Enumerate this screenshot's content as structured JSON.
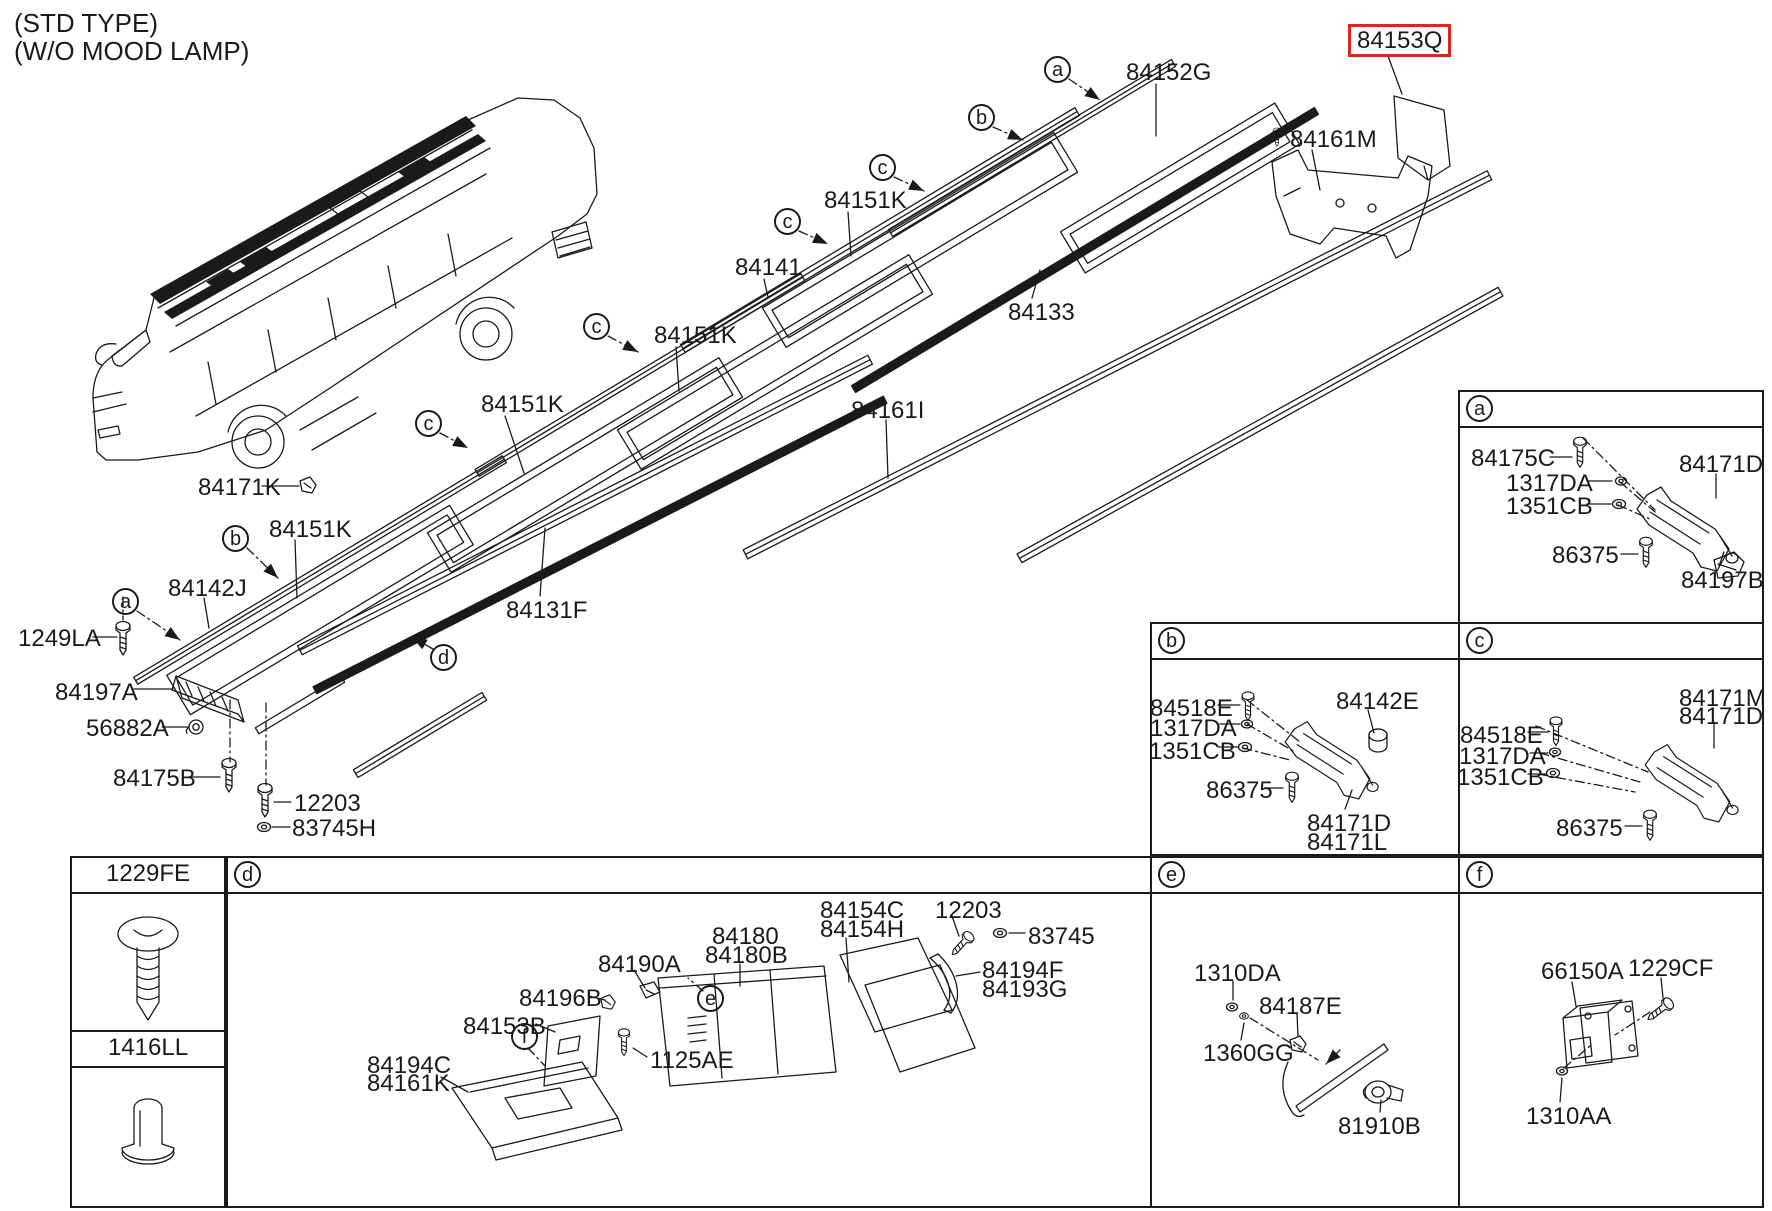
{
  "title": {
    "line1": "(STD TYPE)",
    "line2": "(W/O MOOD LAMP)"
  },
  "accent": {
    "highlight_red": "#e22420",
    "line_color": "#1a1a1a"
  },
  "selected_part": "84153Q",
  "callouts": [
    {
      "t": "84153Q",
      "x": 1348,
      "y": 24,
      "box": "red"
    },
    {
      "t": "84152G",
      "x": 1126,
      "y": 60
    },
    {
      "t": "84161M",
      "x": 1290,
      "y": 127
    },
    {
      "t": "84151K",
      "x": 824,
      "y": 188
    },
    {
      "t": "84141",
      "x": 735,
      "y": 255
    },
    {
      "t": "84133",
      "x": 1008,
      "y": 300
    },
    {
      "t": "84151K",
      "x": 654,
      "y": 323
    },
    {
      "t": "84161I",
      "x": 851,
      "y": 398
    },
    {
      "t": "84151K",
      "x": 481,
      "y": 392
    },
    {
      "t": "84171K",
      "x": 198,
      "y": 475
    },
    {
      "t": "84151K",
      "x": 269,
      "y": 517
    },
    {
      "t": "84142J",
      "x": 168,
      "y": 576
    },
    {
      "t": "1249LA",
      "x": 18,
      "y": 626
    },
    {
      "t": "84131F",
      "x": 506,
      "y": 598
    },
    {
      "t": "84197A",
      "x": 55,
      "y": 680
    },
    {
      "t": "56882A",
      "x": 86,
      "y": 716
    },
    {
      "t": "84175B",
      "x": 113,
      "y": 766
    },
    {
      "t": "12203",
      "x": 294,
      "y": 791
    },
    {
      "t": "83745H",
      "x": 292,
      "y": 816
    },
    {
      "t": "84175C",
      "x": 1471,
      "y": 446
    },
    {
      "t": "1317DA",
      "x": 1506,
      "y": 471
    },
    {
      "t": "1351CB",
      "x": 1506,
      "y": 494
    },
    {
      "t": "84171D",
      "x": 1679,
      "y": 452
    },
    {
      "t": "86375",
      "x": 1552,
      "y": 543
    },
    {
      "t": "84197B",
      "x": 1681,
      "y": 568
    },
    {
      "t": "84518E",
      "x": 1150,
      "y": 696
    },
    {
      "t": "1317DA",
      "x": 1150,
      "y": 716
    },
    {
      "t": "1351CB",
      "x": 1149,
      "y": 739
    },
    {
      "t": "84142E",
      "x": 1336,
      "y": 689
    },
    {
      "t": "86375",
      "x": 1206,
      "y": 778
    },
    {
      "t": "84171D",
      "x": 1307,
      "y": 811
    },
    {
      "t": "84171L",
      "x": 1307,
      "y": 830
    },
    {
      "t": "84518E",
      "x": 1460,
      "y": 723
    },
    {
      "t": "1317DA",
      "x": 1459,
      "y": 744
    },
    {
      "t": "1351CB",
      "x": 1457,
      "y": 765
    },
    {
      "t": "84171M",
      "x": 1679,
      "y": 686
    },
    {
      "t": "84171D",
      "x": 1679,
      "y": 704
    },
    {
      "t": "86375",
      "x": 1556,
      "y": 816
    },
    {
      "t": "84180",
      "x": 712,
      "y": 924
    },
    {
      "t": "84180B",
      "x": 705,
      "y": 943
    },
    {
      "t": "84154C",
      "x": 820,
      "y": 898
    },
    {
      "t": "84154H",
      "x": 820,
      "y": 917
    },
    {
      "t": "12203",
      "x": 935,
      "y": 898
    },
    {
      "t": "83745",
      "x": 1028,
      "y": 924
    },
    {
      "t": "84194F",
      "x": 982,
      "y": 958
    },
    {
      "t": "84193G",
      "x": 982,
      "y": 977
    },
    {
      "t": "84190A",
      "x": 598,
      "y": 952
    },
    {
      "t": "84196B",
      "x": 519,
      "y": 986
    },
    {
      "t": "84153B",
      "x": 463,
      "y": 1014
    },
    {
      "t": "84194C",
      "x": 367,
      "y": 1053
    },
    {
      "t": "84161K",
      "x": 367,
      "y": 1071
    },
    {
      "t": "1125AE",
      "x": 650,
      "y": 1048
    },
    {
      "t": "1310DA",
      "x": 1194,
      "y": 961
    },
    {
      "t": "84187E",
      "x": 1259,
      "y": 994
    },
    {
      "t": "1360GG",
      "x": 1203,
      "y": 1041
    },
    {
      "t": "81910B",
      "x": 1338,
      "y": 1114
    },
    {
      "t": "66150A",
      "x": 1541,
      "y": 959
    },
    {
      "t": "1229CF",
      "x": 1628,
      "y": 956
    },
    {
      "t": "1310AA",
      "x": 1526,
      "y": 1104
    }
  ],
  "markers": [
    {
      "letter": "a",
      "x": 1058,
      "y": 70
    },
    {
      "letter": "b",
      "x": 982,
      "y": 118
    },
    {
      "letter": "c",
      "x": 883,
      "y": 168
    },
    {
      "letter": "c",
      "x": 788,
      "y": 222,
      "n": 2
    },
    {
      "letter": "c",
      "x": 597,
      "y": 327,
      "n": 3
    },
    {
      "letter": "c",
      "x": 429,
      "y": 424,
      "n": 4
    },
    {
      "letter": "b",
      "x": 236,
      "y": 539,
      "n": 2
    },
    {
      "letter": "a",
      "x": 126,
      "y": 602,
      "n": 2
    },
    {
      "letter": "d",
      "x": 444,
      "y": 658
    },
    {
      "letter": "e",
      "x": 711,
      "y": 999
    },
    {
      "letter": "f",
      "x": 525,
      "y": 1037
    }
  ],
  "boxes": {
    "a": {
      "letter": "a"
    },
    "b": {
      "letter": "b"
    },
    "c": {
      "letter": "c"
    },
    "d": {
      "letter": "d"
    },
    "e": {
      "letter": "e"
    },
    "f": {
      "letter": "f"
    }
  },
  "legend": {
    "rows": [
      {
        "code": "1229FE",
        "icon": "tapping-screw"
      },
      {
        "code": "1416LL",
        "icon": "plug-grommet"
      }
    ]
  }
}
